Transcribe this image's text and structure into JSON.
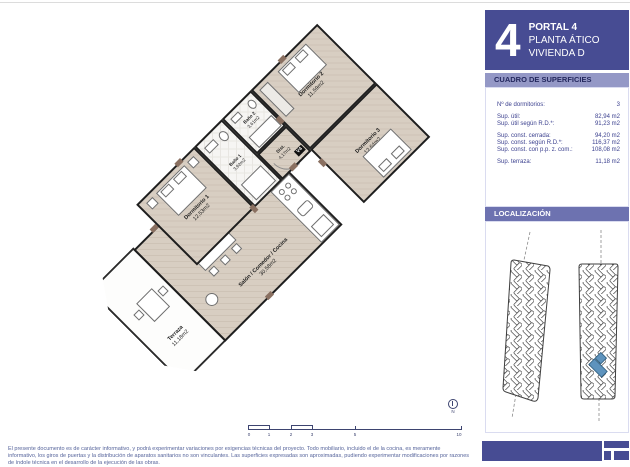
{
  "header": {
    "big_number": "4",
    "portal": "PORTAL 4",
    "planta": "PLANTA ÁTICO",
    "vivienda": "VIVIENDA D"
  },
  "surfaces": {
    "title": "CUADRO DE SUPERFICIES",
    "rows": [
      {
        "label": "Nº de dormitorios:",
        "value": "3"
      },
      {
        "label": "Sup. útil:",
        "value": "82,94 m2"
      },
      {
        "label": "Sup. útil según R.D.*:",
        "value": "91,23 m2"
      },
      {
        "label": "Sup. const. cerrada:",
        "value": "94,20 m2"
      },
      {
        "label": "Sup. const. según R.D.*:",
        "value": "116,37 m2"
      },
      {
        "label": "Sup. const. con p.p. z. com.:",
        "value": "108,08 m2"
      },
      {
        "label": "Sup. terraza:",
        "value": "11,18 m2"
      }
    ]
  },
  "localizacion": {
    "title": "LOCALIZACIÓN"
  },
  "plan": {
    "entry_label": "V4",
    "rooms": {
      "terraza": {
        "name": "Terraza",
        "area": "11,18m2"
      },
      "salon": {
        "name": "Salón / Comedor / Cocina",
        "area": "30,58m2"
      },
      "dorm1": {
        "name": "Dormitorio 1",
        "area": "12,53m2"
      },
      "dorm2": {
        "name": "Dormitorio 2",
        "area": "11,59m2"
      },
      "dorm3": {
        "name": "Dormitorio 3",
        "area": "12,64m2"
      },
      "bano1": {
        "name": "Baño 1",
        "area": "3,92m2"
      },
      "bano2": {
        "name": "Baño 2",
        "area": "3,61m2"
      },
      "dist": {
        "name": "Dist.",
        "area": "4,17m2"
      }
    }
  },
  "scalebar": {
    "ticks": [
      "0",
      "1",
      "2",
      "3",
      "5",
      "10"
    ]
  },
  "north_label": "N",
  "disclaimer": "El presente documento es de carácter informativo, y podrá experimentar variaciones por exigencias técnicas del proyecto. Todo mobiliario, incluido el de la cocina, es meramente informativo, los giros de puertas y la distribución de aparatos sanitarios no son vinculantes. Las superficies expresadas son aproximadas, pudiendo experimentar modificaciones por razones de índole técnica en el desarrollo de la ejecución de las obras.",
  "colors": {
    "sidebar_dark": "#474c93",
    "sidebar_light": "#9498c6",
    "sidebar_mid": "#6d72b0",
    "highlight_unit": "#5e93bd",
    "wood": "#d6cbbf"
  }
}
